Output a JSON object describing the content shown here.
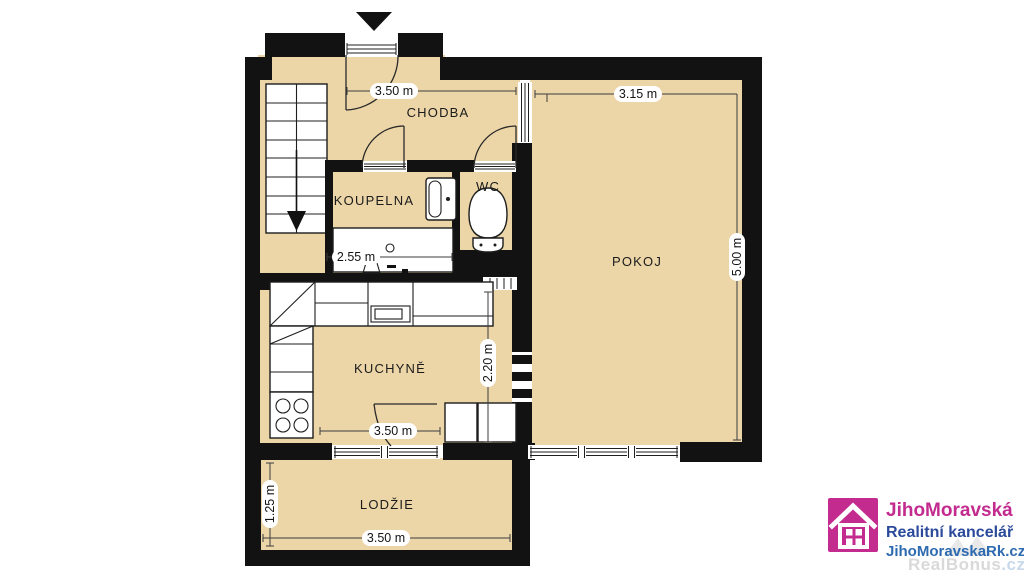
{
  "floorplan": {
    "rooms": {
      "chodba": {
        "label": "CHODBA"
      },
      "koupelna": {
        "label": "KOUPELNA"
      },
      "wc": {
        "label": "WC"
      },
      "pokoj": {
        "label": "POKOJ"
      },
      "kuchyne": {
        "label": "KUCHYNĚ"
      },
      "lodzie": {
        "label": "LODŽIE"
      }
    },
    "dims": {
      "entry_width": "3.50 m",
      "pokoj_width": "3.15 m",
      "pokoj_depth": "5.00 m",
      "koupelna_width": "2.55 m",
      "kuchyne_depth": "2.20 m",
      "kuchyne_width": "3.50 m",
      "lodzie_depth": "1.25 m",
      "lodzie_width": "3.50 m"
    },
    "icons": {
      "entrance": "entrance-arrow-icon",
      "stairs": "staircase-down-arrow"
    },
    "colors": {
      "floor": "#ecd6a8",
      "wall": "#121212"
    }
  },
  "branding": {
    "company": "JihoMoravská",
    "tagline": "Realitní kancelář",
    "website": "JihoMoravskaRk.cz",
    "watermark": "RealBonus",
    "watermark_tld": ".cz",
    "colors": {
      "magenta": "#c32b8f",
      "blue": "#2b4a9c",
      "link_blue": "#2e6bb0",
      "watermark_gray": "#d9d9d9",
      "watermark_blue": "#c9d9ec"
    }
  }
}
